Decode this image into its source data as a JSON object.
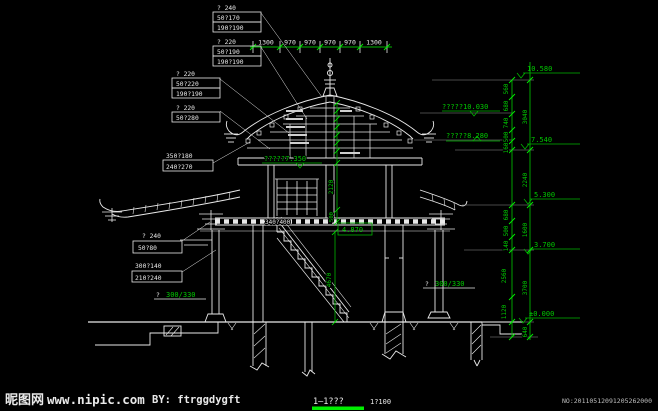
{
  "colors": {
    "background": "#000000",
    "line_white": "#e9e9e9",
    "dim_green": "#00b400",
    "bright_green": "#00ee00",
    "faint": "#8f8f8f"
  },
  "top_chain": {
    "values": [
      "1300",
      "970",
      "970",
      "970",
      "970",
      "1300"
    ]
  },
  "spec_boxes": {
    "b1": {
      "header": "? 240",
      "r1": "50?170",
      "r2": "190?190"
    },
    "b2": {
      "header": "? 220",
      "r1": "50?190",
      "r2": "190?190"
    },
    "b3": {
      "header": "? 220",
      "r1": "50?220",
      "r2": "190?190"
    },
    "b4": {
      "header": "? 220",
      "r1": "50?280"
    },
    "b5": {
      "r1": "350?180",
      "r2": "240?270"
    },
    "b6": {
      "header": "? 240",
      "r1": "50?80"
    },
    "b7": {
      "r1": "300?140",
      "r2": "210?240"
    }
  },
  "column_spec": {
    "left_prefix": "?",
    "left_value": "300/330",
    "right_prefix": "?",
    "right_value": "300/330"
  },
  "elevations": {
    "top": "10.580",
    "upper_eave": "?????10.030",
    "lower_ridge": "?????8.280",
    "floor2": "?????7.350",
    "plate": "7.540",
    "balcony": "5.300",
    "lower_eave": "3.700",
    "ground": "±0.000",
    "landing": "4.870"
  },
  "dims_right_outer": {
    "d1": "3040",
    "d2": "2240",
    "d3": "1600",
    "d4": "3700"
  },
  "dims_right_inner": {
    "d1": "560",
    "d2": "680",
    "d3": "740",
    "d4": "500",
    "d5": "160",
    "d6": "680",
    "d7": "500",
    "d8": "140",
    "d9": "2560",
    "d10": "1120",
    "d11": "640"
  },
  "dims_mid": {
    "d1": "2120",
    "d2": "500",
    "d3": "4670"
  },
  "beam_label": "340?400",
  "footer": {
    "section_name": "1—1???",
    "scale_ratio": "1?100",
    "serial": "NO:20110512091205262000"
  },
  "watermark": {
    "site": "昵图网",
    "url": "www.nipic.com",
    "author": "BY: ftrggdygft"
  }
}
